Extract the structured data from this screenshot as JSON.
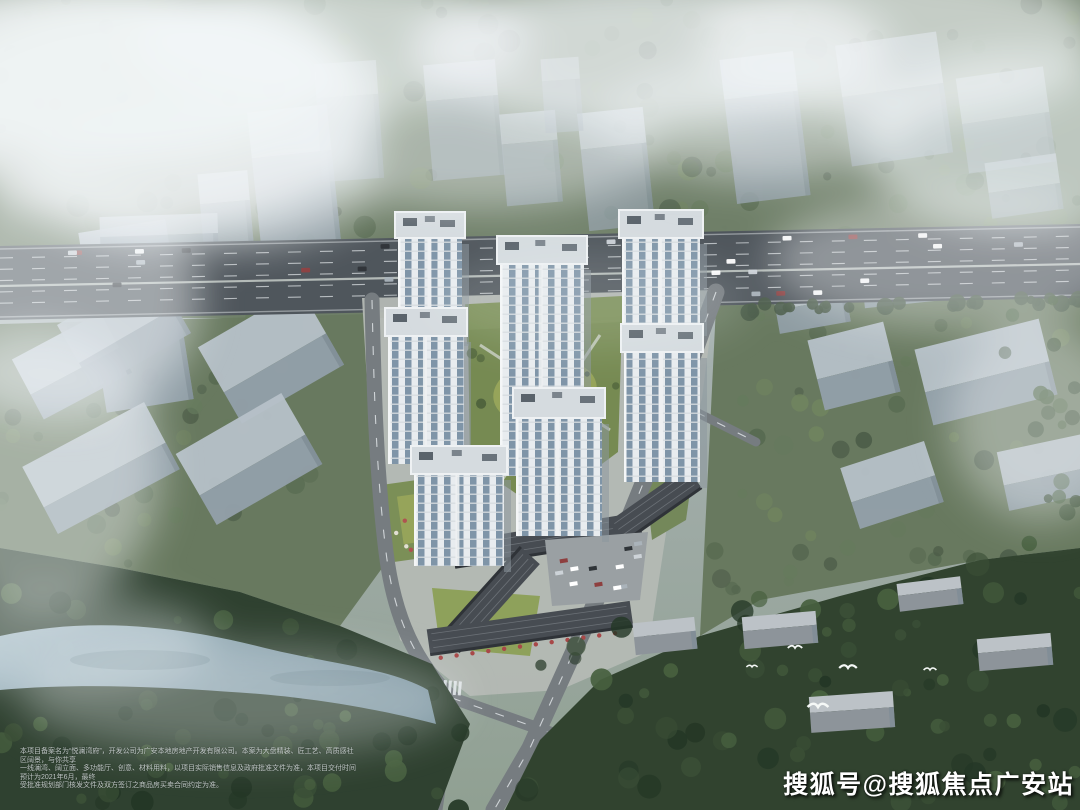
{
  "watermark": {
    "text": "搜狐号@搜狐焦点广安站"
  },
  "disclaimer": {
    "line1": "本项目备案名为“悦澜湾府”，开发公司为广安本地房地产开发有限公司。本案为大盘精装、匠工艺、高质感社区阔景，与你共享",
    "line2": "一线澜湾、阔立面、多功能厅、创意、材料用料，以项目实际销售信息及政府批准文件为准，本项目交付时间预计为2021年6月，最终",
    "line3": "受批准规划部门核发文件及双方签订之商品房买卖合同约定为准。"
  },
  "colors": {
    "sky_fog": "#b9c3c9",
    "cloud": "#f2f6f8",
    "massing_block_top": "#b7c1c9",
    "massing_block_side": "#93a0aa",
    "tower_facade": "#e8ecef",
    "tower_glass": "#7f95a8",
    "tower_roof": "#d5dbdf",
    "courtyard_green": "#768a52",
    "lawn_bright": "#96a45a",
    "forest_muted": "#68795f",
    "woods_dark": "#2f4130",
    "river": "#a3bac6",
    "highway": "#4f565c",
    "road": "#767c80",
    "commercial_roof": "#474c52",
    "storefront_red": "#a84848",
    "watermark_text": "#ffffff"
  }
}
